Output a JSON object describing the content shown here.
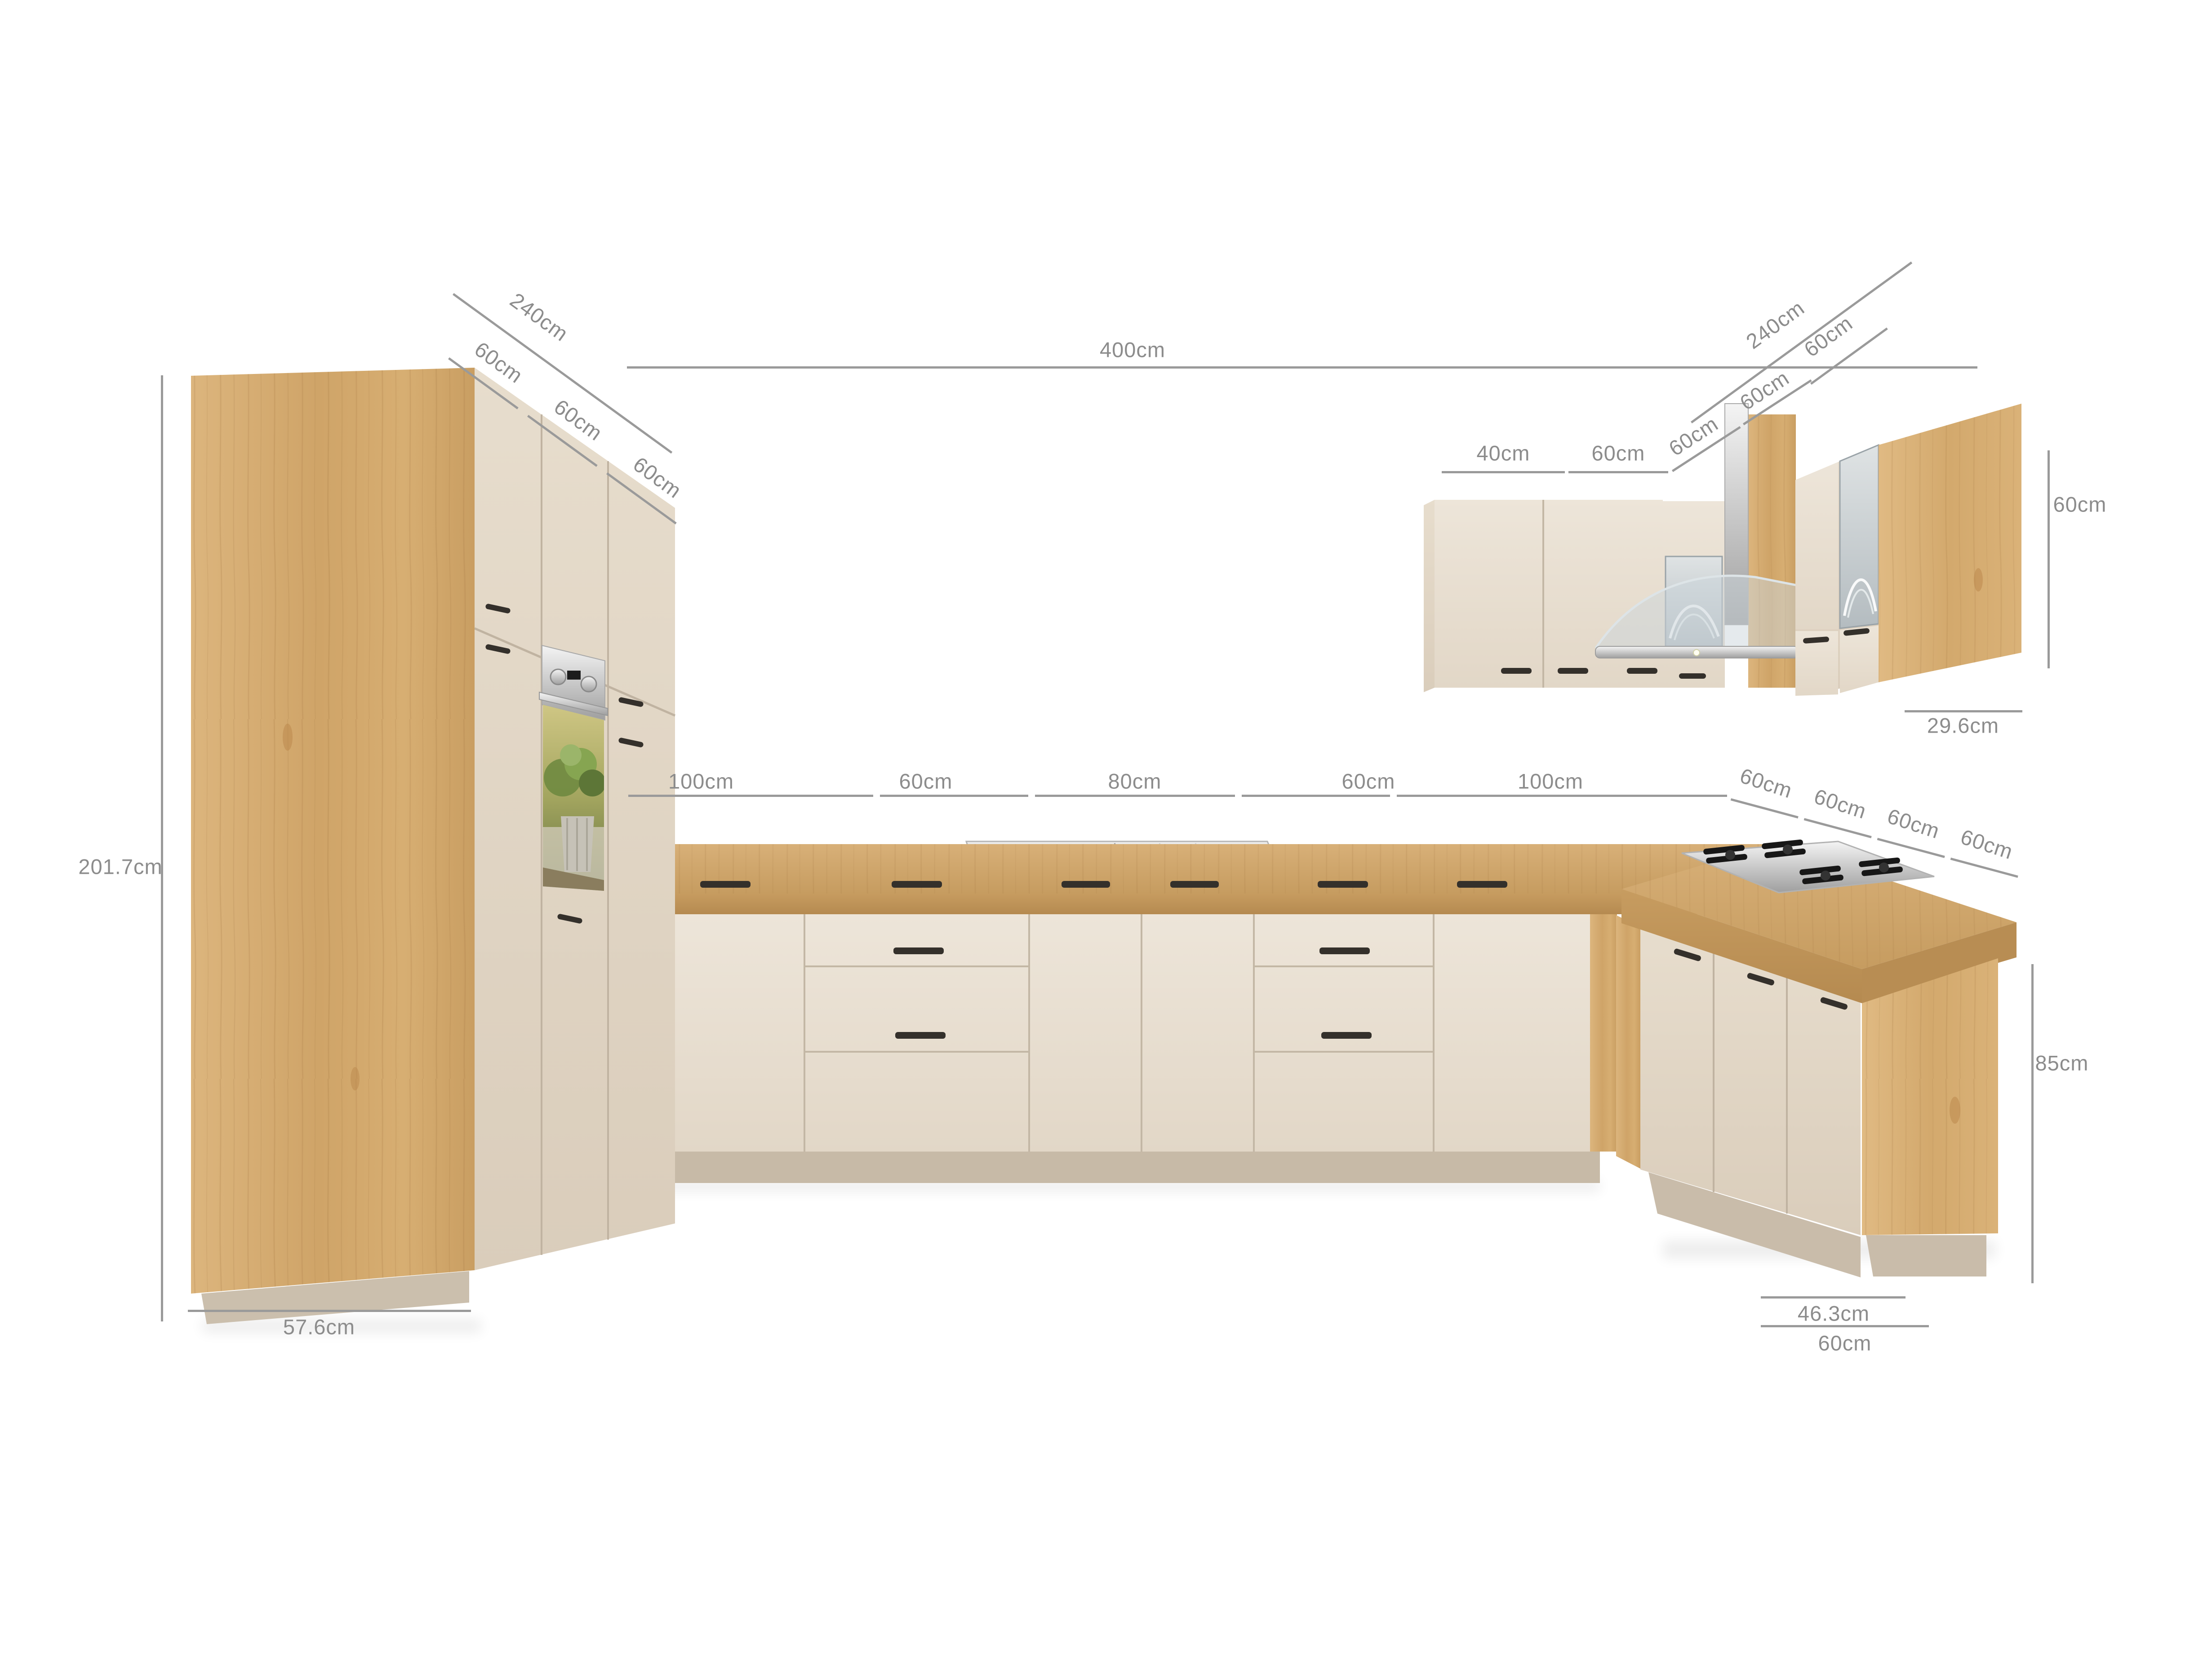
{
  "annotations": {
    "left_run_total": "240cm",
    "left_run_seg_1": "60cm",
    "left_run_seg_2": "60cm",
    "left_run_seg_3": "60cm",
    "back_wall_total": "400cm",
    "right_run_total": "240cm",
    "right_wall_unit_width": "60cm",
    "wall_unit_40": "40cm",
    "wall_unit_60": "60cm",
    "wall_corner_seg_1": "60cm",
    "wall_corner_seg_2": "60cm",
    "wall_unit_height": "60cm",
    "wall_unit_depth": "29.6cm",
    "base_seg_1": "100cm",
    "base_seg_2": "60cm",
    "base_seg_3": "80cm",
    "base_seg_4": "60cm",
    "base_seg_5": "100cm",
    "peninsula_seg_1": "60cm",
    "peninsula_seg_2": "60cm",
    "peninsula_seg_3": "60cm",
    "peninsula_seg_4": "60cm",
    "tall_unit_height": "201.7cm",
    "tall_unit_depth": "57.6cm",
    "worktop_height": "85cm",
    "peninsula_end_depth": "46.3cm",
    "peninsula_end_width": "60cm"
  },
  "palette": {
    "background": "#ffffff",
    "front_cream": "#eae1d4",
    "front_cream_shade": "#ddd1c1",
    "wood_light_oak": "#d6ad74",
    "wood_counter": "#cda569",
    "plinth_beige": "#c8bba8",
    "handle_black": "#34302b",
    "dimension_gray": "#9a9a9a",
    "label_gray": "#8c8c8c",
    "steel_silver": "#d9d9d9",
    "hob_black": "#171717"
  }
}
